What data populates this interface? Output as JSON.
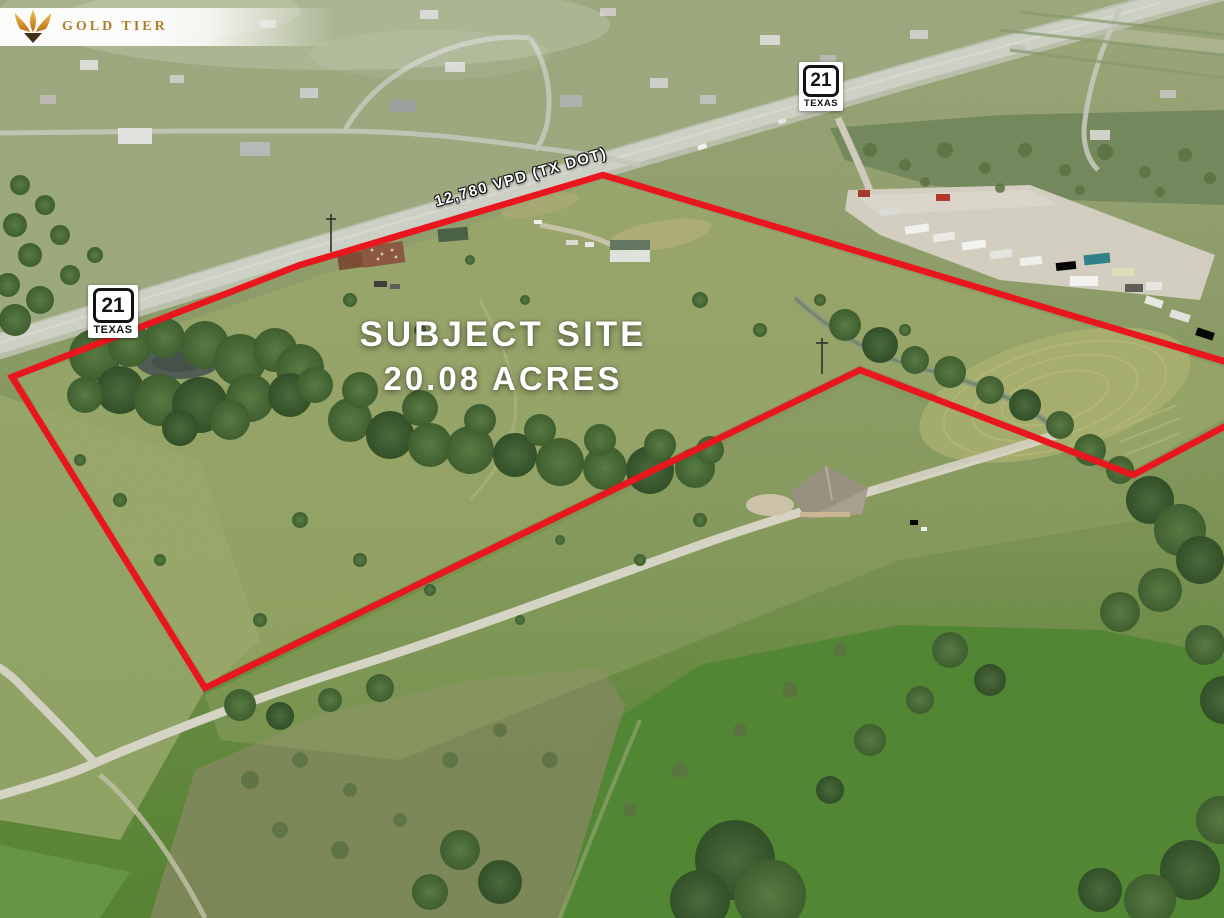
{
  "logo": {
    "name": "GOLD TIER"
  },
  "overlay": {
    "site_title": "SUBJECT SITE",
    "site_acreage": "20.08 ACRES",
    "traffic_label": "12,780 VPD (TX DOT)"
  },
  "highway_shields": [
    {
      "number": "21",
      "state": "TEXAS",
      "position": "top"
    },
    {
      "number": "21",
      "state": "TEXAS",
      "position": "left"
    }
  ],
  "colors": {
    "boundary_red": "#e9161d",
    "overlay_text": "#ffffff",
    "logo_gold": "#a9812e",
    "shield_bg": "#ffffff",
    "shield_text": "#141414"
  }
}
